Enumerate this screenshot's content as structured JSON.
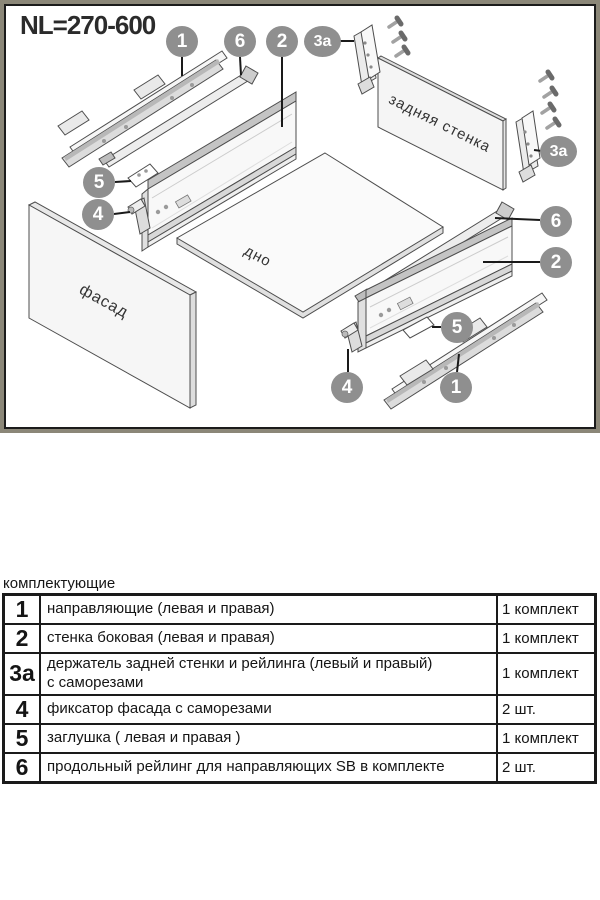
{
  "title": "NL=270-600",
  "diagram": {
    "labels": {
      "back_wall": "задняя стенка",
      "bottom": "дно",
      "facade": "фасад"
    },
    "callouts": {
      "c1": "1",
      "c2": "2",
      "c3a": "3a",
      "c4": "4",
      "c5": "5",
      "c6": "6"
    }
  },
  "table": {
    "caption": "комплектующие",
    "rows": [
      {
        "num": "1",
        "desc": "направляющие (левая и правая)",
        "qty": "1 комплект"
      },
      {
        "num": "2",
        "desc": "стенка боковая (левая и правая)",
        "qty": "1 комплект"
      },
      {
        "num": "3a",
        "desc": "держатель задней стенки и рейлинга  (левый и правый)\nс саморезами",
        "qty": "1 комплект"
      },
      {
        "num": "4",
        "desc": "фиксатор фасада с саморезами",
        "qty": "2 шт."
      },
      {
        "num": "5",
        "desc": "заглушка ( левая и правая )",
        "qty": "1 комплект"
      },
      {
        "num": "6",
        "desc": "продольный рейлинг для направляющих SB в комплекте",
        "qty": "2 шт."
      }
    ]
  },
  "colors": {
    "frame_outer": "#8b8778",
    "frame_inner": "#1b1b1b",
    "callout_bg": "#8f8f8f",
    "callout_text": "#ffffff",
    "part_outline": "#4d4d4d"
  }
}
